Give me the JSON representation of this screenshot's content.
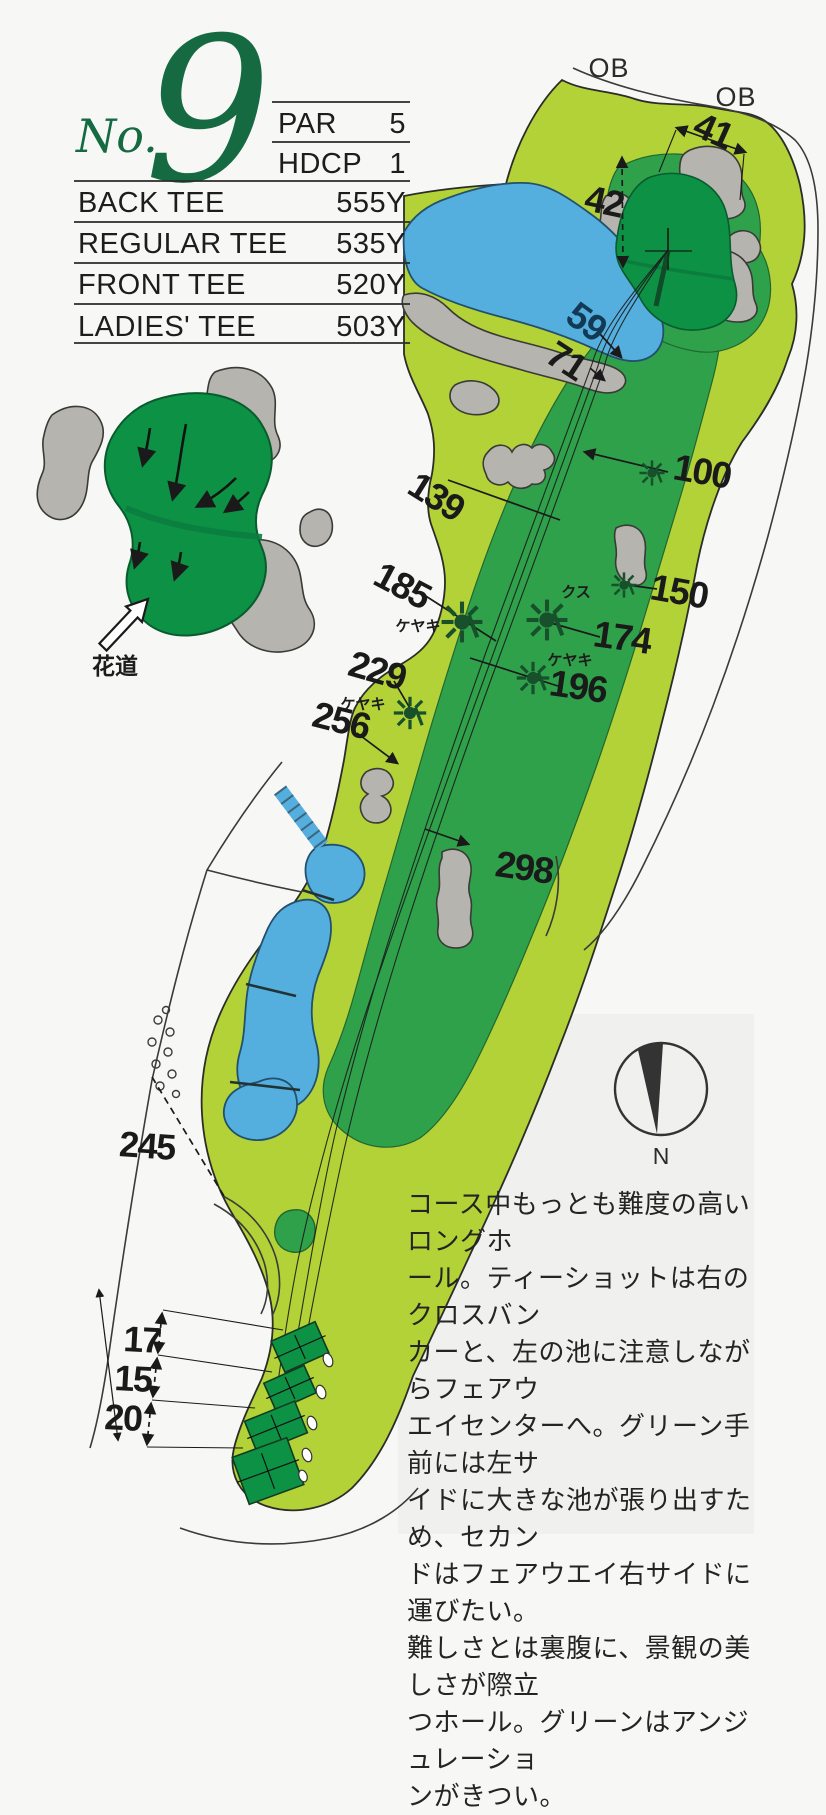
{
  "header": {
    "hole_prefix": "No.",
    "hole_number": "9",
    "stats": [
      {
        "label": "PAR",
        "value": "5"
      },
      {
        "label": "HDCP",
        "value": "1"
      }
    ],
    "tees": [
      {
        "label": "BACK TEE",
        "value": "555Y"
      },
      {
        "label": "REGULAR TEE",
        "value": "535Y"
      },
      {
        "label": "FRONT TEE",
        "value": "520Y"
      },
      {
        "label": "LADIES' TEE",
        "value": "503Y"
      }
    ]
  },
  "map": {
    "ob_labels": [
      "OB",
      "OB"
    ],
    "compass_label": "N",
    "approach_label": "花道",
    "trees": {
      "t185": "ケヤキ",
      "t174": "クス",
      "t196": "ケヤキ",
      "t229": "ケヤキ"
    },
    "yardages": {
      "y41": "41",
      "y42": "42",
      "y59": "59",
      "y71": "71",
      "y100": "100",
      "y139": "139",
      "y150": "150",
      "y174": "174",
      "y185": "185",
      "y196": "196",
      "y229": "229",
      "y256": "256",
      "y298": "298",
      "y245": "245",
      "y17": "17",
      "y15": "15",
      "y20": "20"
    }
  },
  "description": {
    "text": "コース中もっとも難度の高いロングホ\nール。ティーショットは右のクロスバン\nカーと、左の池に注意しながらフェアウ\nエイセンターへ。グリーン手前には左サ\nイドに大きな池が張り出すため、セカン\nドはフェアウエイ右サイドに運びたい。\n難しさとは裏腹に、景観の美しさが際立\nつホール。グリーンはアンジュレーショ\nンがきつい。"
  },
  "colors": {
    "rough": "#b2d237",
    "fairway": "#2fa14b",
    "green_dark": "#0c9145",
    "water": "#54aede",
    "bunker": "#b5b4ae",
    "outline": "#2c2c28",
    "header_green": "#156a42",
    "text": "#1f1f1f"
  }
}
